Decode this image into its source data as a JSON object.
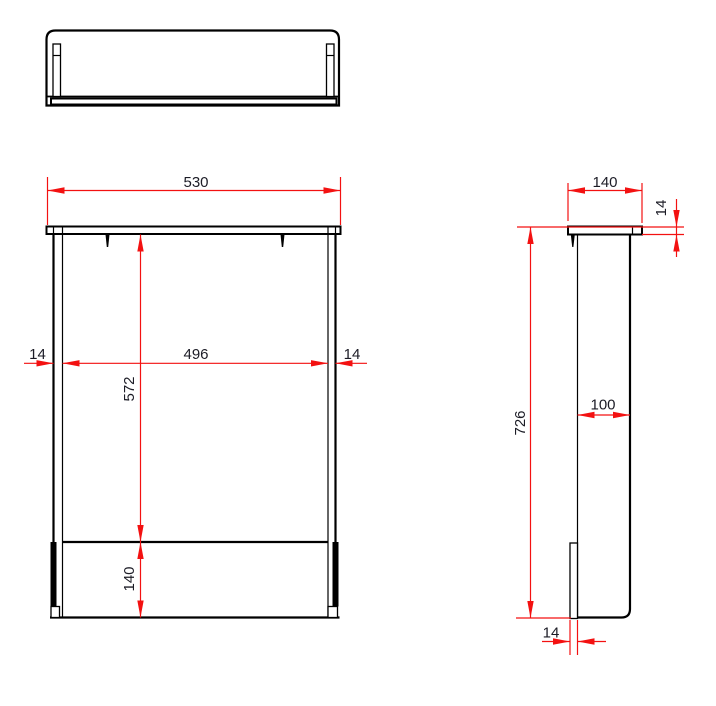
{
  "drawing": {
    "type": "furniture-orthographic-technical-drawing",
    "dimensions": {
      "front_view": {
        "overall_width": "530",
        "left_panel_thickness": "14",
        "inner_width": "496",
        "right_panel_thickness": "14",
        "opening_height": "572",
        "bottom_rail_height": "140"
      },
      "side_view": {
        "top_depth": "140",
        "top_panel_thickness": "14",
        "overall_height": "726",
        "side_panel_depth": "100",
        "front_rail_thickness": "14"
      }
    },
    "colors": {
      "outline": "#000000",
      "dimension": "#f31111",
      "label_text": "#1c1c26",
      "background": "#ffffff"
    }
  }
}
